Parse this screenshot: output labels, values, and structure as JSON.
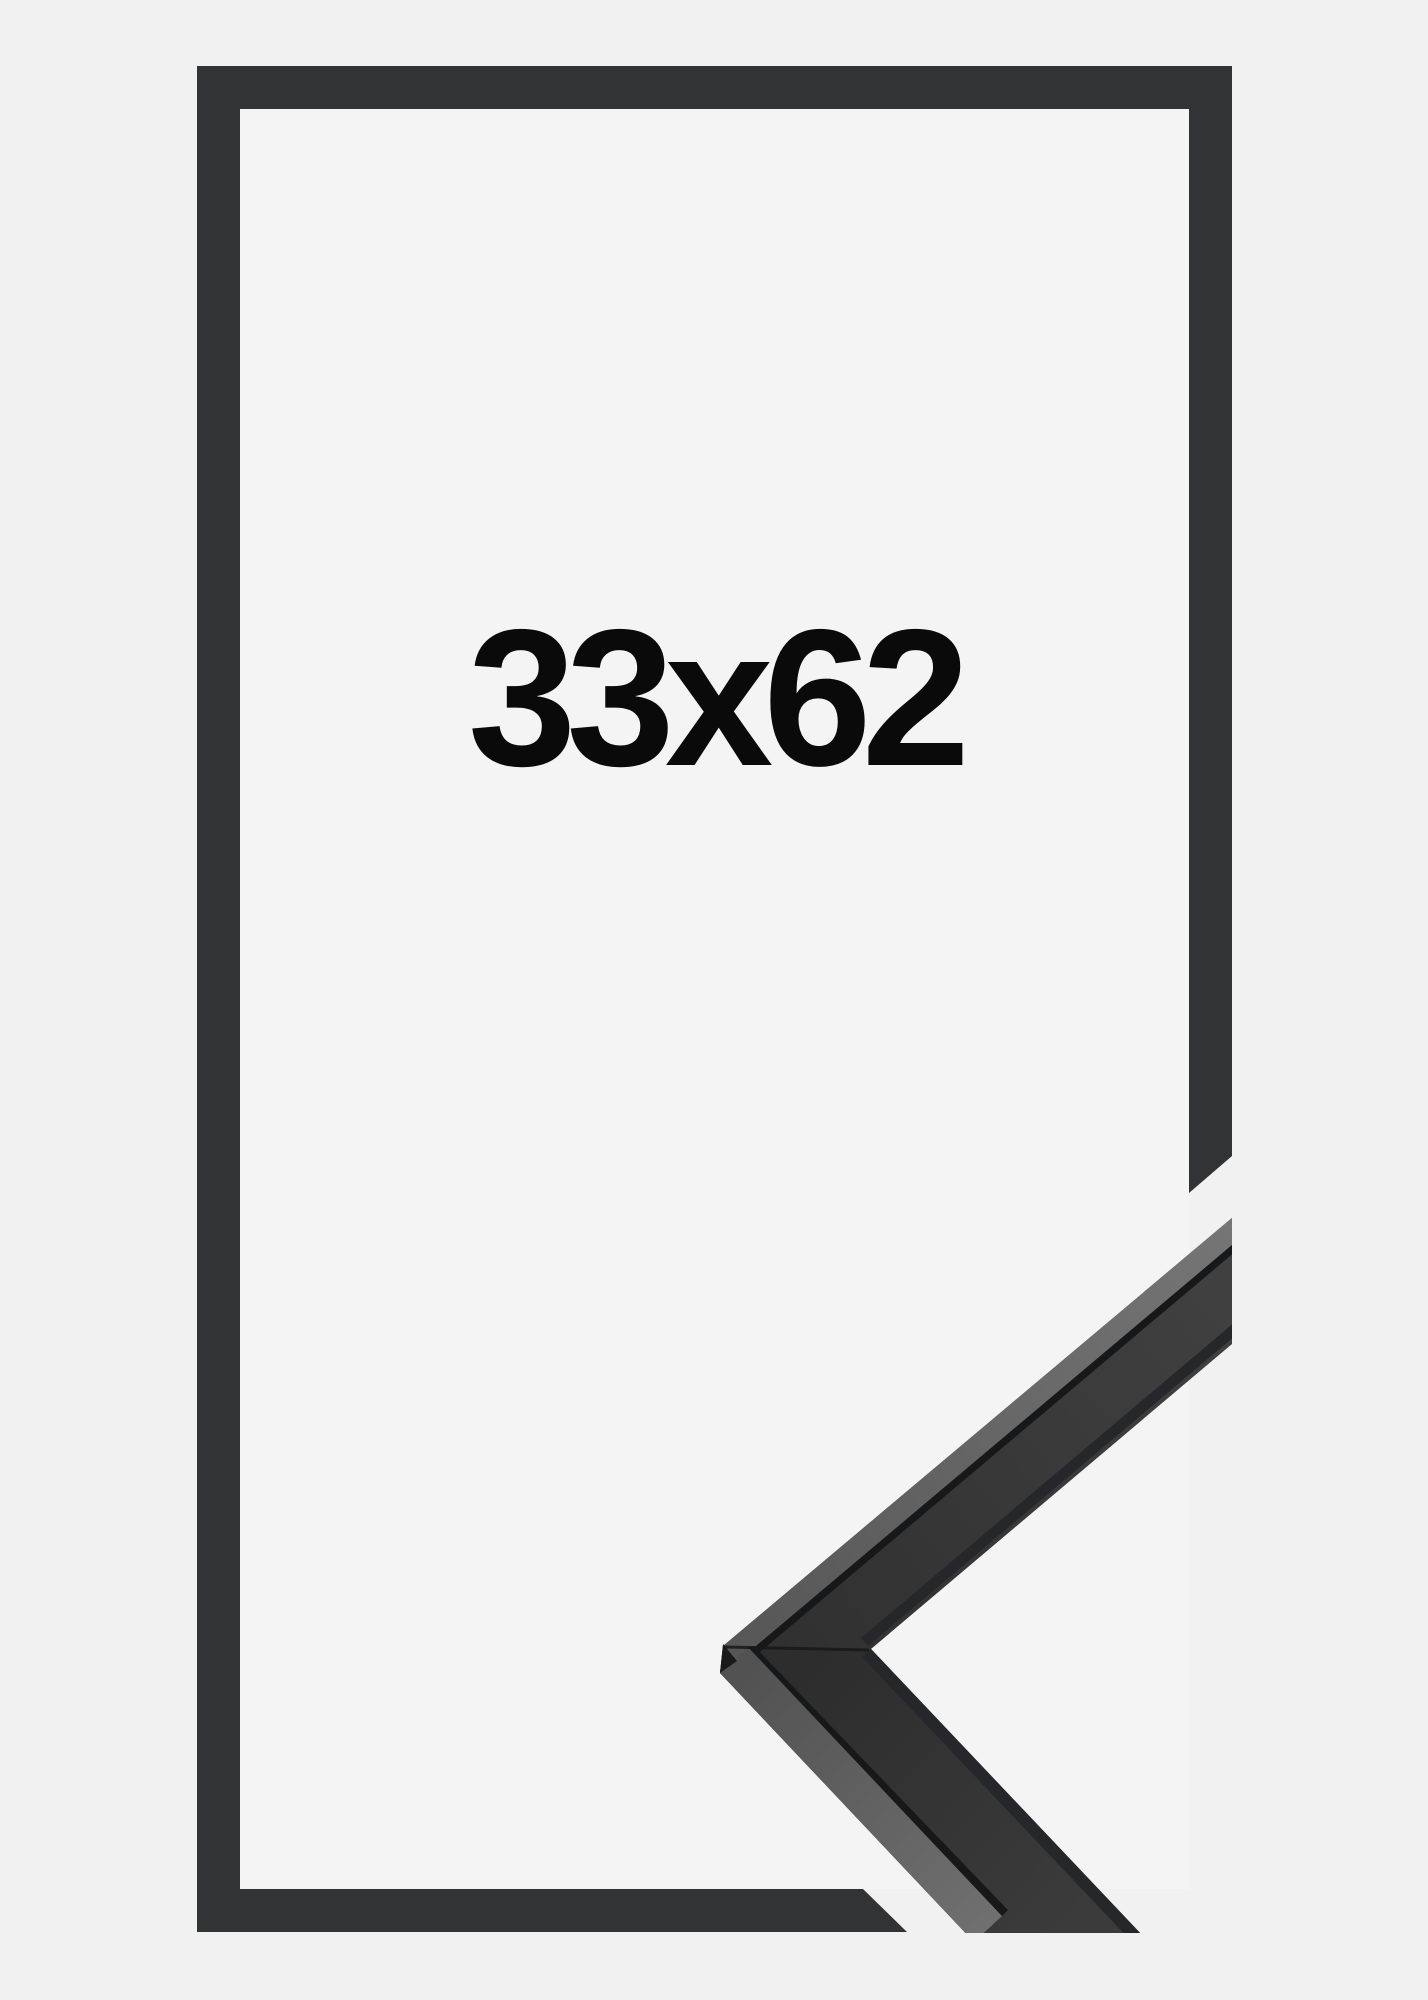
{
  "product": {
    "size_label": "33x62"
  },
  "colors": {
    "page_background": "#f1f1f2",
    "inner_background": "#f4f4f5",
    "frame_outline": "#313335",
    "molding_top_face": "#383838",
    "molding_side_face": "#666666",
    "molding_edge_line": "#17181a",
    "molding_inner_lip": "#26272a",
    "molding_vertex_facet": "#1a1a1a",
    "label_text": "#0a0a0a"
  }
}
